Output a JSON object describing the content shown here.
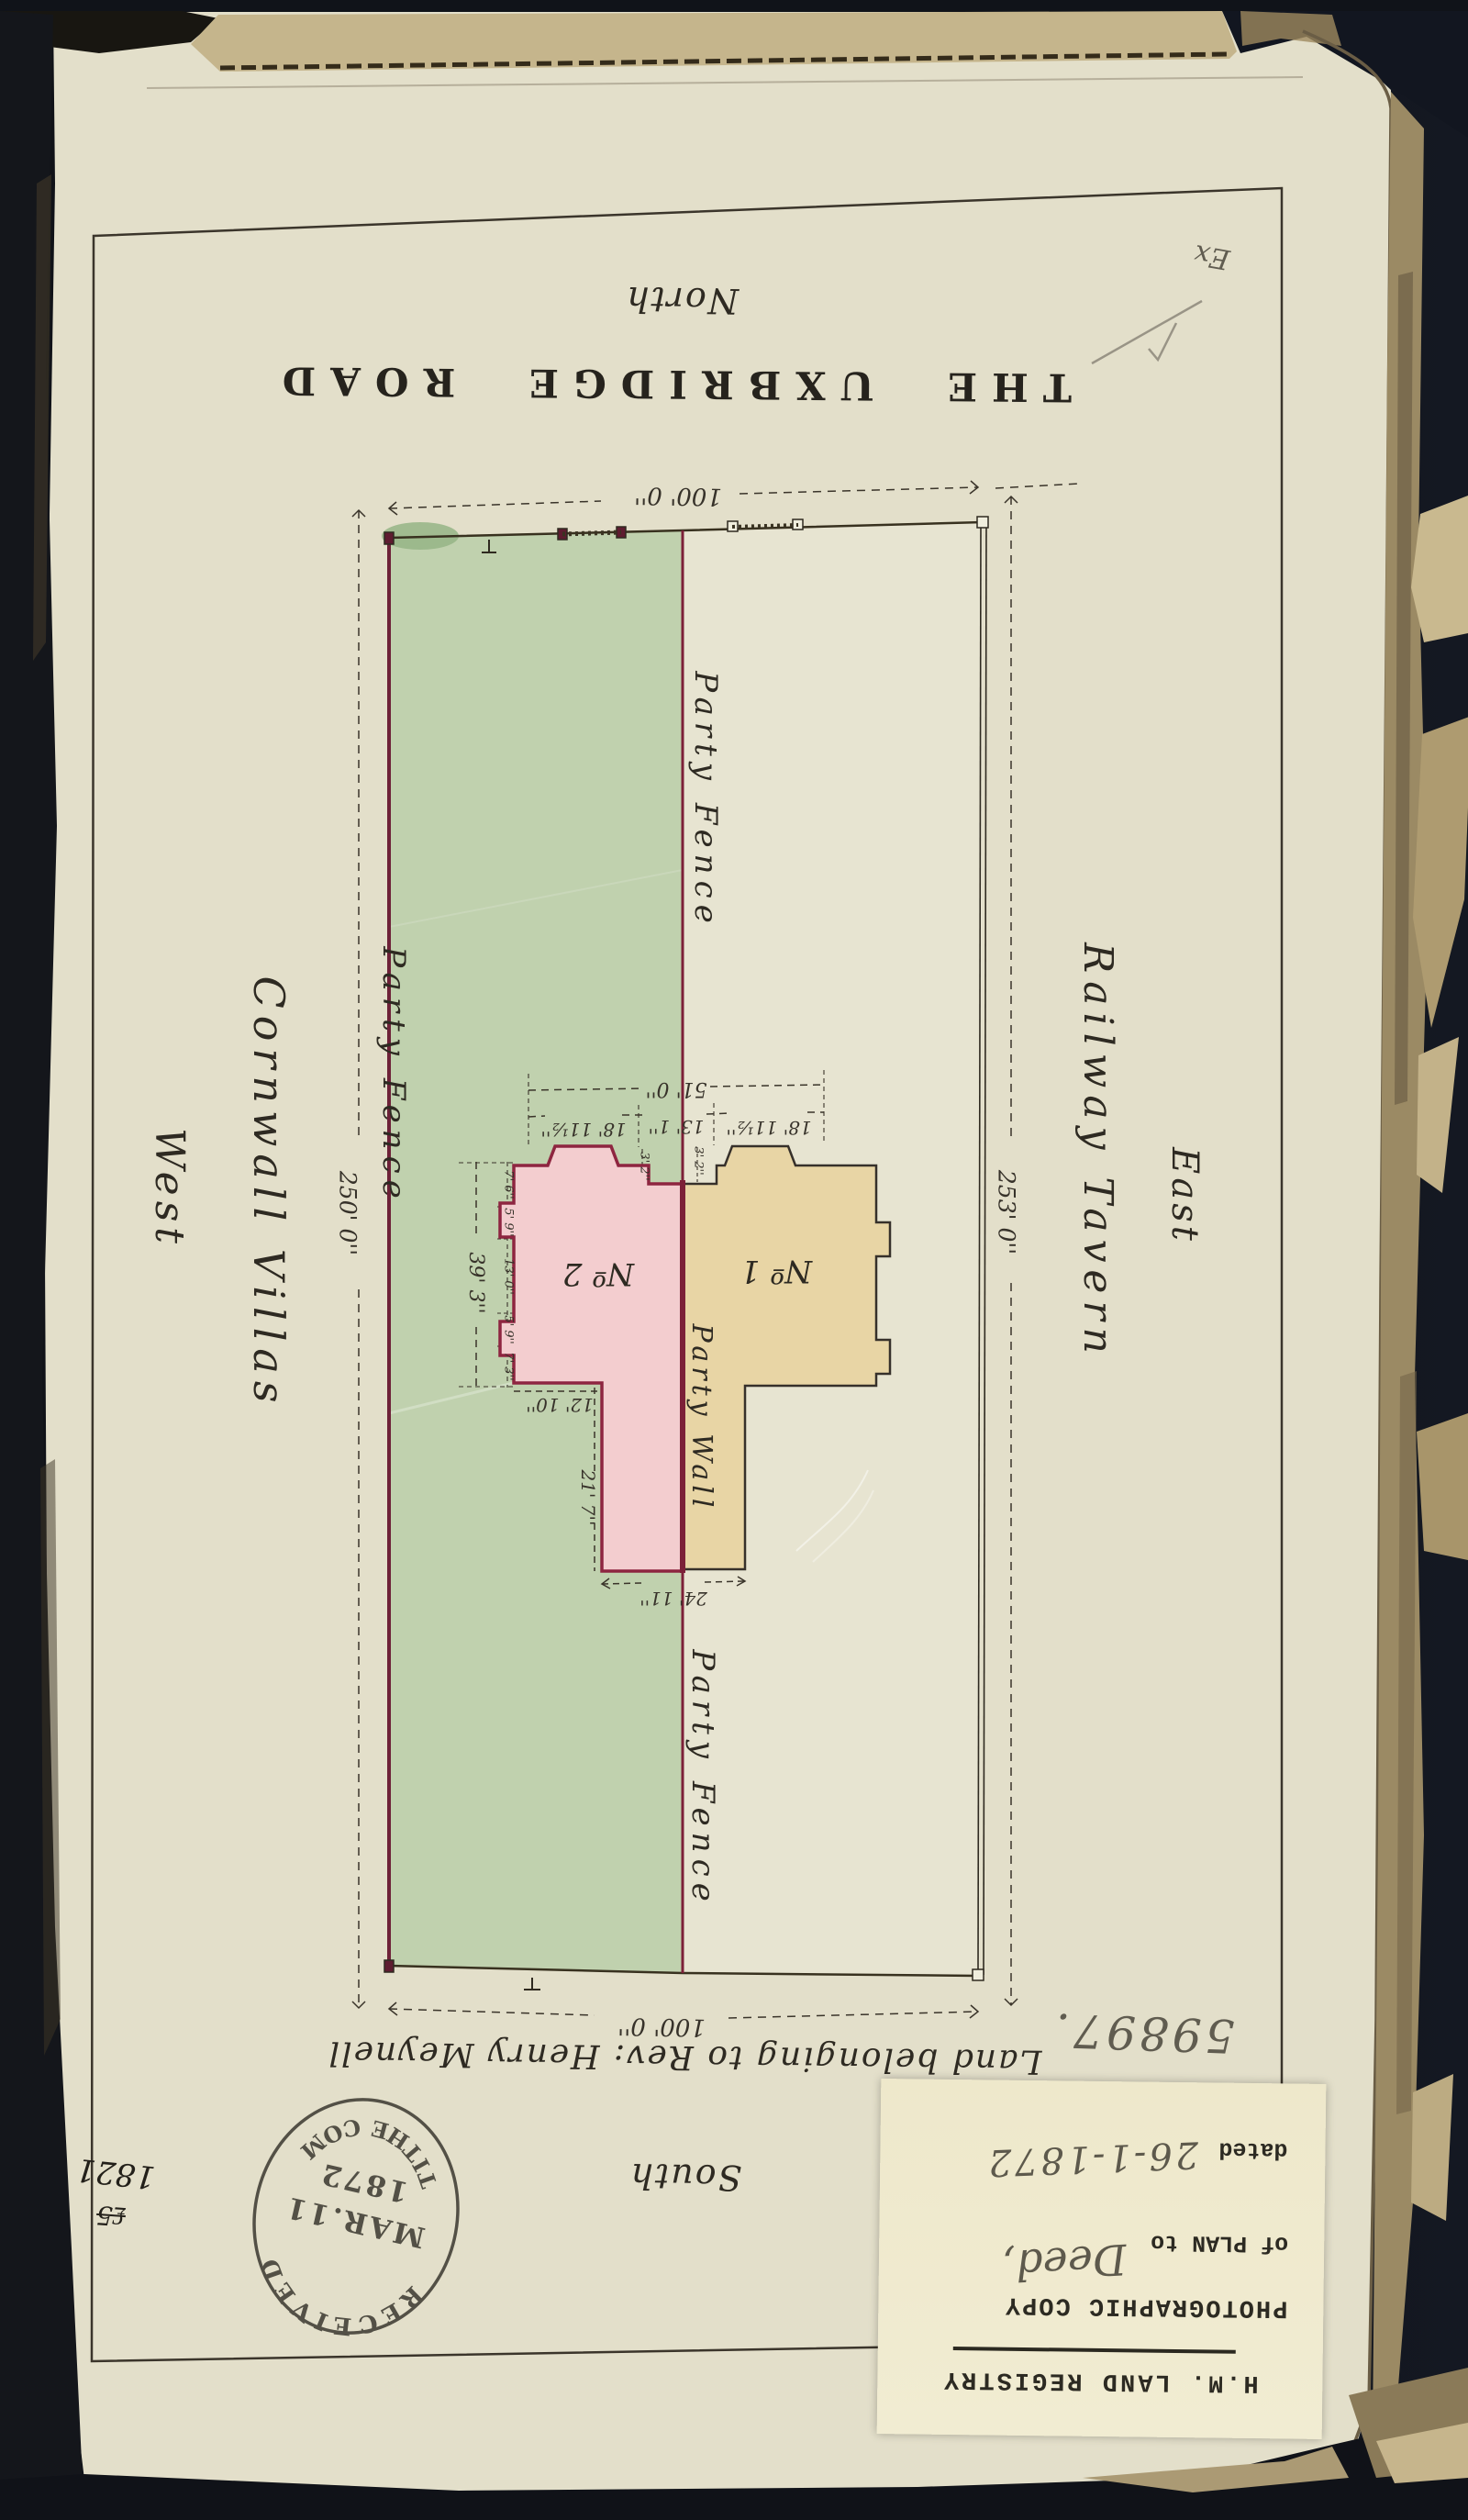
{
  "plan": {
    "north_label": "North",
    "road_title": "THE UXBRIDGE ROAD",
    "south_label": "South",
    "west_label": "West",
    "east_label": "East",
    "west_side_name": "Cornwall Villas",
    "east_side_name": "Railway Tavern",
    "owner_note": "Land belonging to Rev: Henry Meynell",
    "party_fence_west": "Party Fence",
    "party_fence_top": "Party Fence",
    "party_fence_bottom": "Party Fence",
    "party_wall": "Party Wall",
    "house_2": "Nº 2",
    "house_1": "Nº 1",
    "dims": {
      "frontage_north": "100' 0''",
      "frontage_south": "100' 0''",
      "depth_west": "250' 0''",
      "depth_east": "253' 0''",
      "houses_total": "51' 0''",
      "bay_west": "18' 11½''",
      "centre": "13' 1''",
      "bay_east": "18' 11½''",
      "step_west": "3' 2''",
      "step_east": "3' 2''",
      "flank_total": "39' 3''",
      "flank_parts": [
        "7' 6''",
        "5' 9''",
        "13' 0''",
        "5' 9''",
        "7' 3''"
      ],
      "wing_offset": "12' 10''",
      "wing_depth": "21' 7''",
      "wings_width": "24' 11''"
    }
  },
  "stamp": {
    "arc_top": "RECEIVED",
    "line_1": "MAR.11",
    "line_2": "1872",
    "arc_bottom": "TITHE COM"
  },
  "sticker": {
    "registry": "H.M. LAND REGISTRY",
    "copy_type": "PHOTOGRAPHIC COPY",
    "of_plan_to": "of PLAN to",
    "document_hand": "Deed,",
    "dated_label": "dated",
    "date_hand": "26-1-1872"
  },
  "annotations": {
    "filed_number": "59897.",
    "year_note": "1821",
    "fee_note": "₤5",
    "corner_mark": "Ex"
  },
  "colors": {
    "paper": "#e3dfca",
    "green_plot": "#c0d1ae",
    "maroon": "#7c2038",
    "house_no2_fill": "#f3cdcf",
    "house_no1_fill": "#e8d5a5",
    "ink": "#2e2a22",
    "pencil": "#6f6a5e",
    "sticker": "#f0ebcf",
    "backdrop": "#0e1118"
  }
}
